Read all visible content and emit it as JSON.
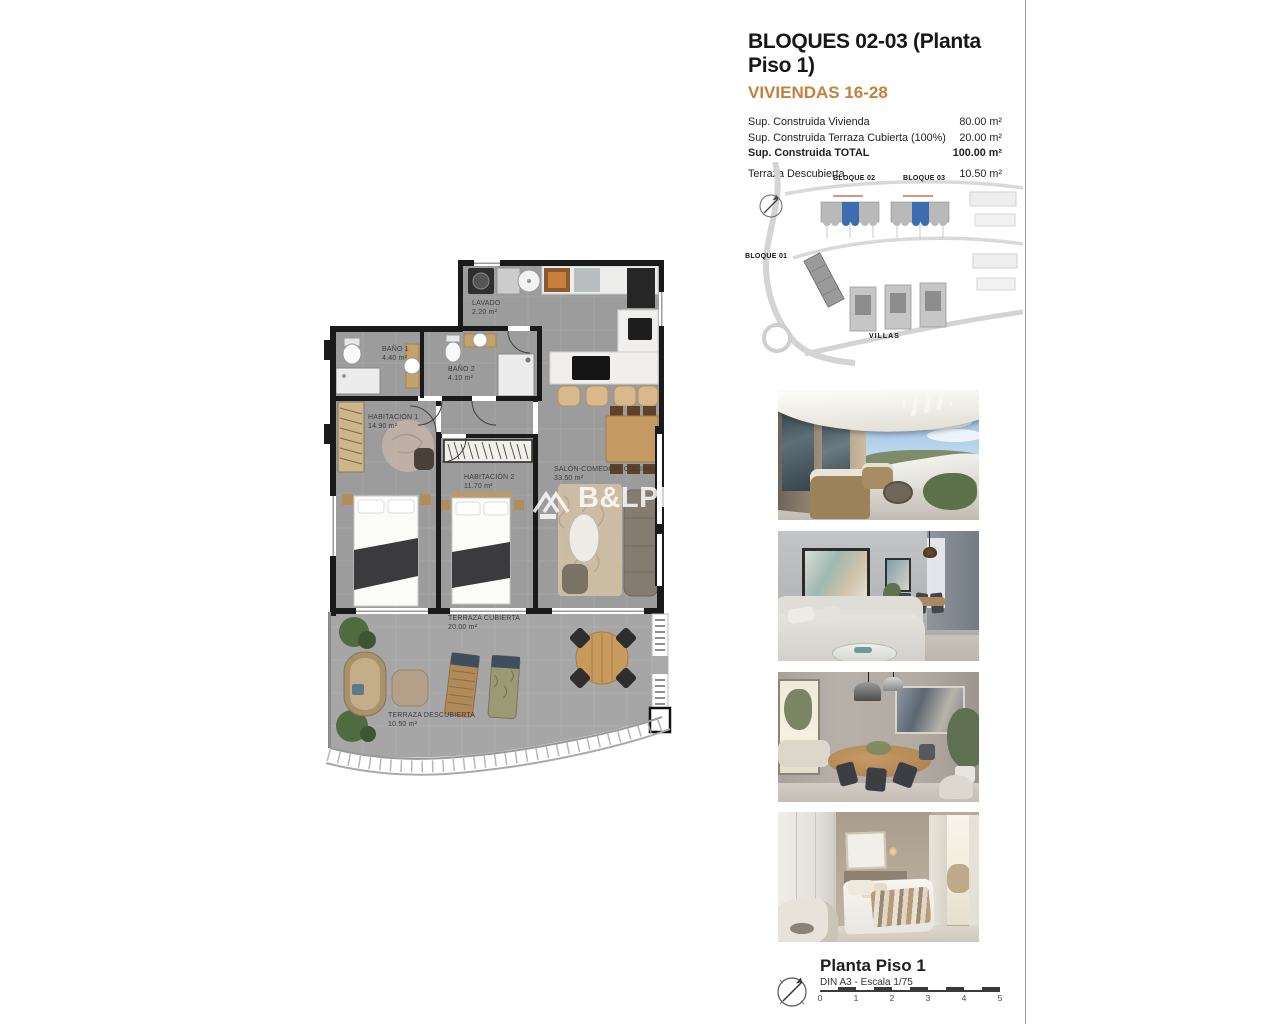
{
  "header": {
    "title": "BLOQUES 02-03  (Planta Piso 1)",
    "subtitle": "VIVIENDAS 16-28",
    "areas": [
      {
        "label": "Sup. Construida Vivienda",
        "value": "80.00 m²"
      },
      {
        "label": "Sup. Construida Terraza Cubierta (100%)",
        "value": "20.00 m²"
      },
      {
        "label": "Sup. Construida TOTAL",
        "value": "100.00 m²"
      },
      {
        "label": "Terraza Descubierta",
        "value": "10.50 m²"
      }
    ]
  },
  "site_plan": {
    "labels": {
      "block02": "BLOQUE 02",
      "block03": "BLOQUE 03",
      "block01": "BLOQUE 01",
      "villas": "VILLAS"
    },
    "highlight_color": "#3C6DB0"
  },
  "floor_plan": {
    "rooms": [
      {
        "name": "LAVADO",
        "area": "2.20 m²"
      },
      {
        "name": "BAÑO 1",
        "area": "4.40 m²"
      },
      {
        "name": "BAÑO 2",
        "area": "4.10 m²"
      },
      {
        "name": "HABITACIÓN 1",
        "area": "14.90 m²"
      },
      {
        "name": "HABITACIÓN 2",
        "area": "11.70 m²"
      },
      {
        "name": "SALÓN-COMEDOR- COCINA",
        "area": "33.50 m²"
      },
      {
        "name": "TERRAZA CUBIERTA",
        "area": "20.00 m²"
      },
      {
        "name": "TERRAZA DESCUBIERTA",
        "area": "10.50 m²"
      }
    ],
    "watermark": {
      "brand": "B&LPROM",
      "sub": "COSTA"
    }
  },
  "photos": [
    {
      "name": "terrace-exterior-render"
    },
    {
      "name": "living-room-render"
    },
    {
      "name": "dining-room-render"
    },
    {
      "name": "bedroom-render"
    }
  ],
  "footer": {
    "title": "Planta Piso 1",
    "scale_note": "DIN A3 - Escala 1/75",
    "scale_ticks": [
      "0",
      "1",
      "2",
      "3",
      "4",
      "5"
    ]
  },
  "colors": {
    "accent_orange": "#C5813C",
    "highlight_blue": "#3C6DB0",
    "wall_black": "#1A1A1A",
    "floor_gray": "#9C9C9C"
  }
}
